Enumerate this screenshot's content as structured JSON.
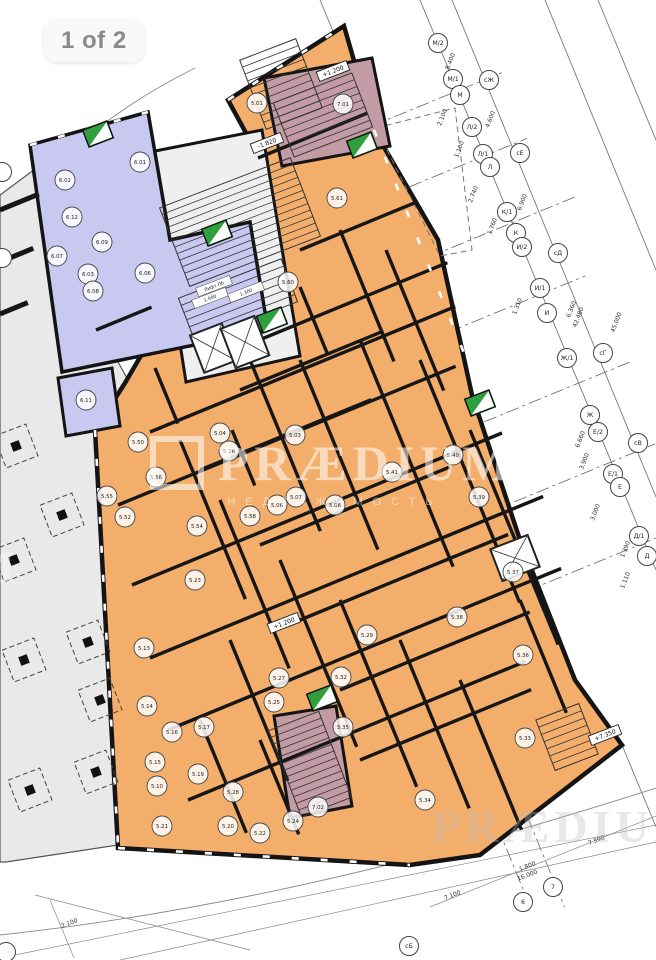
{
  "badge": {
    "label": "1 of 2"
  },
  "watermark": {
    "brand": "PRÆDIUM",
    "subtitle": "НЕДВИЖИМОСТЬ"
  },
  "colors": {
    "orange": "#F4AE6C",
    "purple": "#C9C8F0",
    "gray": "#E9E9E9",
    "core": "#EFEFEF",
    "mauve": "#C39BA4",
    "green": "#2FA03C",
    "wall": "#161616",
    "grid": "#777777"
  },
  "plan": {
    "zones": [
      {
        "name": "zone-gray-commercial",
        "fill": "#E9E9E9",
        "stroke": "#555555",
        "w": 1.2,
        "points": [
          [
            0,
            195
          ],
          [
            58,
            152
          ],
          [
            96,
            322
          ],
          [
            128,
            380
          ],
          [
            100,
            432
          ],
          [
            118,
            845
          ],
          [
            6,
            862
          ],
          [
            0,
            862
          ]
        ]
      },
      {
        "name": "zone-orange-apartments",
        "fill": "#F4AE6C",
        "stroke": "#141414",
        "w": 4.5,
        "points": [
          [
            228,
            100
          ],
          [
            344,
            26
          ],
          [
            374,
            130
          ],
          [
            438,
            240
          ],
          [
            472,
            395
          ],
          [
            520,
            540
          ],
          [
            575,
            680
          ],
          [
            622,
            745
          ],
          [
            480,
            855
          ],
          [
            410,
            865
          ],
          [
            118,
            848
          ],
          [
            95,
            430
          ],
          [
            125,
            383
          ],
          [
            258,
            155
          ]
        ]
      },
      {
        "name": "zone-terrace",
        "fill": "none",
        "stroke": "#777777",
        "w": 1,
        "dash": "6 4",
        "points": [
          [
            376,
            128
          ],
          [
            455,
            108
          ],
          [
            472,
            250
          ],
          [
            440,
            256
          ]
        ]
      },
      {
        "name": "zone-core",
        "fill": "#EFEFEF",
        "stroke": "#141414",
        "w": 3,
        "points": [
          [
            150,
            152
          ],
          [
            262,
            130
          ],
          [
            300,
            356
          ],
          [
            186,
            382
          ]
        ]
      },
      {
        "name": "zone-purple-offices",
        "fill": "#C9C8F0",
        "stroke": "#141414",
        "w": 3.5,
        "points": [
          [
            30,
            145
          ],
          [
            148,
            112
          ],
          [
            170,
            240
          ],
          [
            250,
            222
          ],
          [
            268,
            330
          ],
          [
            62,
            372
          ]
        ]
      },
      {
        "name": "zone-purple-small",
        "fill": "#C9C8F0",
        "stroke": "#141414",
        "w": 3,
        "points": [
          [
            58,
            378
          ],
          [
            112,
            368
          ],
          [
            120,
            426
          ],
          [
            66,
            436
          ]
        ]
      },
      {
        "name": "zone-stairwell-top",
        "fill": "#C39BA4",
        "stroke": "#141414",
        "w": 3,
        "points": [
          [
            264,
            78
          ],
          [
            372,
            58
          ],
          [
            390,
            146
          ],
          [
            282,
            166
          ]
        ]
      },
      {
        "name": "zone-stairwell-bottom",
        "fill": "#C39BA4",
        "stroke": "#141414",
        "w": 3,
        "points": [
          [
            274,
            716
          ],
          [
            336,
            706
          ],
          [
            352,
            806
          ],
          [
            290,
            818
          ]
        ]
      }
    ],
    "walls_h": [
      [
        258,
        158,
        118
      ],
      [
        230,
        352,
        235
      ],
      [
        150,
        432,
        330
      ],
      [
        118,
        505,
        365
      ],
      [
        132,
        585,
        400
      ],
      [
        150,
        658,
        425
      ],
      [
        168,
        730,
        425
      ],
      [
        188,
        800,
        365
      ],
      [
        300,
        250,
        125
      ],
      [
        240,
        390,
        155
      ],
      [
        200,
        470,
        185
      ],
      [
        260,
        545,
        205
      ],
      [
        300,
        620,
        225
      ],
      [
        340,
        690,
        205
      ],
      [
        360,
        760,
        185
      ],
      [
        96,
        330,
        60
      ],
      [
        0,
        210,
        42,
        5
      ],
      [
        0,
        262,
        36,
        5
      ],
      [
        0,
        314,
        30,
        5
      ]
    ],
    "walls_v": [
      [
        300,
        287,
        72
      ],
      [
        340,
        230,
        142
      ],
      [
        386,
        250,
        152
      ],
      [
        300,
        360,
        205
      ],
      [
        360,
        340,
        245
      ],
      [
        420,
        360,
        262
      ],
      [
        470,
        430,
        232
      ],
      [
        250,
        360,
        185
      ],
      [
        180,
        440,
        172
      ],
      [
        220,
        500,
        182
      ],
      [
        280,
        560,
        202
      ],
      [
        340,
        600,
        202
      ],
      [
        400,
        640,
        182
      ],
      [
        460,
        680,
        162
      ],
      [
        520,
        600,
        122
      ],
      [
        230,
        640,
        152
      ],
      [
        200,
        720,
        122
      ],
      [
        260,
        740,
        102
      ],
      [
        155,
        368,
        60
      ],
      [
        232,
        430,
        60
      ]
    ],
    "windows": [
      [
        95,
        430,
        118,
        845
      ],
      [
        118,
        848,
        410,
        865
      ],
      [
        228,
        100,
        344,
        26
      ],
      [
        374,
        130,
        622,
        745
      ],
      [
        30,
        145,
        148,
        112
      ]
    ],
    "stairs": [
      [
        281,
        84,
        60,
        74
      ],
      [
        323,
        115,
        84,
        58
      ],
      [
        240,
        222,
        140,
        84
      ],
      [
        238,
        300,
        110,
        46
      ],
      [
        567,
        737,
        46,
        54
      ],
      [
        310,
        764,
        54,
        92
      ]
    ],
    "elevators": [
      [
        213,
        348,
        34,
        40
      ],
      [
        245,
        342,
        36,
        42
      ],
      [
        515,
        558,
        40,
        34
      ]
    ],
    "green_shafts": [
      [
        98,
        134
      ],
      [
        217,
        233
      ],
      [
        272,
        320
      ],
      [
        362,
        145
      ],
      [
        480,
        403
      ],
      [
        322,
        698
      ]
    ],
    "columns": [
      [
        16,
        446
      ],
      [
        62,
        515
      ],
      [
        24,
        660
      ],
      [
        88,
        642
      ],
      [
        30,
        790
      ],
      [
        96,
        772
      ],
      [
        14,
        560
      ],
      [
        100,
        700
      ]
    ],
    "core_labels": [
      [
        214,
        286,
        "Лифт ПБ"
      ],
      [
        210,
        298,
        "1.000"
      ],
      [
        246,
        292,
        "1.300"
      ]
    ],
    "room_bubbles": [
      [
        140,
        162,
        "6.01"
      ],
      [
        65,
        180,
        "6.02"
      ],
      [
        72,
        217,
        "6.12"
      ],
      [
        102,
        242,
        "6.09"
      ],
      [
        57,
        256,
        "6.07"
      ],
      [
        88,
        274,
        "6.03"
      ],
      [
        93,
        291,
        "6.08"
      ],
      [
        145,
        273,
        "6.06"
      ],
      [
        86,
        400,
        "6.11"
      ],
      [
        257,
        103,
        "5.01"
      ],
      [
        343,
        104,
        "7.01"
      ],
      [
        337,
        198,
        "5.61"
      ],
      [
        288,
        282,
        "5.60"
      ],
      [
        220,
        433,
        "5.04"
      ],
      [
        229,
        451,
        "5.26"
      ],
      [
        295,
        435,
        "5.03"
      ],
      [
        296,
        497,
        "5.07"
      ],
      [
        277,
        505,
        "5.06"
      ],
      [
        335,
        505,
        "5.08"
      ],
      [
        453,
        455,
        "5.40"
      ],
      [
        392,
        472,
        "5.41"
      ],
      [
        479,
        497,
        "5.39"
      ],
      [
        156,
        477,
        "5.56"
      ],
      [
        107,
        496,
        "5.55"
      ],
      [
        138,
        442,
        "5.50"
      ],
      [
        125,
        517,
        "5.52"
      ],
      [
        197,
        526,
        "5.54"
      ],
      [
        250,
        516,
        "5.58"
      ],
      [
        195,
        580,
        "5.23"
      ],
      [
        144,
        648,
        "5.13"
      ],
      [
        367,
        635,
        "5.29"
      ],
      [
        279,
        678,
        "5.27"
      ],
      [
        147,
        706,
        "5.14"
      ],
      [
        274,
        702,
        "5.25"
      ],
      [
        341,
        677,
        "5.32"
      ],
      [
        172,
        732,
        "5.16"
      ],
      [
        204,
        727,
        "5.17"
      ],
      [
        343,
        727,
        "5.35"
      ],
      [
        155,
        762,
        "5.15"
      ],
      [
        198,
        774,
        "5.19"
      ],
      [
        157,
        786,
        "5.10"
      ],
      [
        233,
        792,
        "5.28"
      ],
      [
        318,
        807,
        "7.02"
      ],
      [
        293,
        821,
        "5.24"
      ],
      [
        228,
        826,
        "5.20"
      ],
      [
        260,
        833,
        "5.22"
      ],
      [
        162,
        826,
        "5.21"
      ],
      [
        523,
        655,
        "5.36"
      ],
      [
        513,
        572,
        "5.37"
      ],
      [
        457,
        617,
        "5.38"
      ],
      [
        425,
        800,
        "5.34"
      ],
      [
        525,
        738,
        "5.33"
      ]
    ]
  },
  "grid": {
    "curves": [
      "M -6 235 Q 70 130 195 68",
      "M 0 935 Q 300 903 656 788"
    ],
    "long_lines": [
      [
        420,
        0,
        656,
        570
      ],
      [
        452,
        0,
        656,
        497
      ],
      [
        545,
        0,
        656,
        270
      ],
      [
        598,
        0,
        656,
        140
      ],
      [
        320,
        0,
        374,
        130
      ],
      [
        622,
        745,
        656,
        827
      ]
    ],
    "cross_lines": [
      [
        350,
        135,
        165
      ],
      [
        365,
        205,
        175
      ],
      [
        385,
        275,
        205
      ],
      [
        405,
        350,
        195
      ],
      [
        440,
        440,
        205
      ],
      [
        470,
        520,
        200
      ],
      [
        505,
        600,
        180
      ]
    ],
    "cross_steep": [
      [
        470,
        760,
        160
      ],
      [
        500,
        750,
        170
      ]
    ],
    "misc_lines": [
      [
        35,
        895,
        250,
        950
      ],
      [
        50,
        900,
        74,
        958
      ],
      [
        430,
        907,
        656,
        816
      ],
      [
        0,
        958,
        656,
        825
      ],
      [
        120,
        960,
        656,
        842
      ]
    ],
    "axis_bubbles": [
      [
        438,
        43,
        "М/2"
      ],
      [
        453,
        79,
        "М/1"
      ],
      [
        460,
        95,
        "М"
      ],
      [
        489,
        80,
        "сЖ"
      ],
      [
        472,
        127,
        "Л/2"
      ],
      [
        483,
        154,
        "Л/1"
      ],
      [
        490,
        167,
        "Л"
      ],
      [
        520,
        153,
        "сЕ"
      ],
      [
        507,
        212,
        "К/1"
      ],
      [
        516,
        233,
        "К"
      ],
      [
        522,
        247,
        "И/2"
      ],
      [
        558,
        253,
        "сД"
      ],
      [
        540,
        288,
        "И/1"
      ],
      [
        547,
        313,
        "И"
      ],
      [
        567,
        358,
        "Ж/1"
      ],
      [
        603,
        353,
        "сГ"
      ],
      [
        590,
        415,
        "Ж"
      ],
      [
        598,
        432,
        "Е/2"
      ],
      [
        638,
        443,
        "сВ"
      ],
      [
        613,
        474,
        "Е/1"
      ],
      [
        620,
        487,
        "Е"
      ],
      [
        639,
        536,
        "Д/1"
      ],
      [
        647,
        556,
        "Д"
      ],
      [
        523,
        902,
        "6"
      ],
      [
        553,
        887,
        "7"
      ],
      [
        409,
        946,
        "сБ"
      ],
      [
        2,
        172,
        ""
      ],
      [
        2,
        258,
        ""
      ],
      [
        6,
        952,
        ""
      ]
    ],
    "dimensions": [
      [
        452,
        62,
        "8.400",
        -69
      ],
      [
        444,
        118,
        "2.100",
        -69
      ],
      [
        461,
        150,
        "1.100",
        -69
      ],
      [
        492,
        120,
        "4.600",
        -69
      ],
      [
        475,
        195,
        "2.740",
        -69
      ],
      [
        494,
        227,
        "1.760",
        -69
      ],
      [
        524,
        203,
        "6.900",
        -69
      ],
      [
        519,
        307,
        "1.310",
        -69
      ],
      [
        573,
        310,
        "6.360",
        -69
      ],
      [
        580,
        318,
        "42.480",
        -69
      ],
      [
        618,
        323,
        "45.000",
        -69
      ],
      [
        586,
        462,
        "3.900",
        -69
      ],
      [
        597,
        513,
        "3.000",
        -69
      ],
      [
        627,
        550,
        "1.390",
        -69
      ],
      [
        627,
        581,
        "1.110",
        -69
      ],
      [
        582,
        440,
        "6.660",
        -69
      ],
      [
        597,
        842,
        "7.590",
        -21
      ],
      [
        528,
        868,
        "1.800",
        -21
      ],
      [
        528,
        877,
        "16.000",
        -21
      ],
      [
        453,
        897,
        "7.100",
        -21
      ],
      [
        70,
        925,
        "2.100",
        -21
      ]
    ],
    "elevations": [
      [
        333,
        71,
        "+1.200"
      ],
      [
        267,
        143,
        "-1.820"
      ],
      [
        284,
        623,
        "+1.200"
      ],
      [
        605,
        735,
        "+7.350"
      ]
    ]
  }
}
